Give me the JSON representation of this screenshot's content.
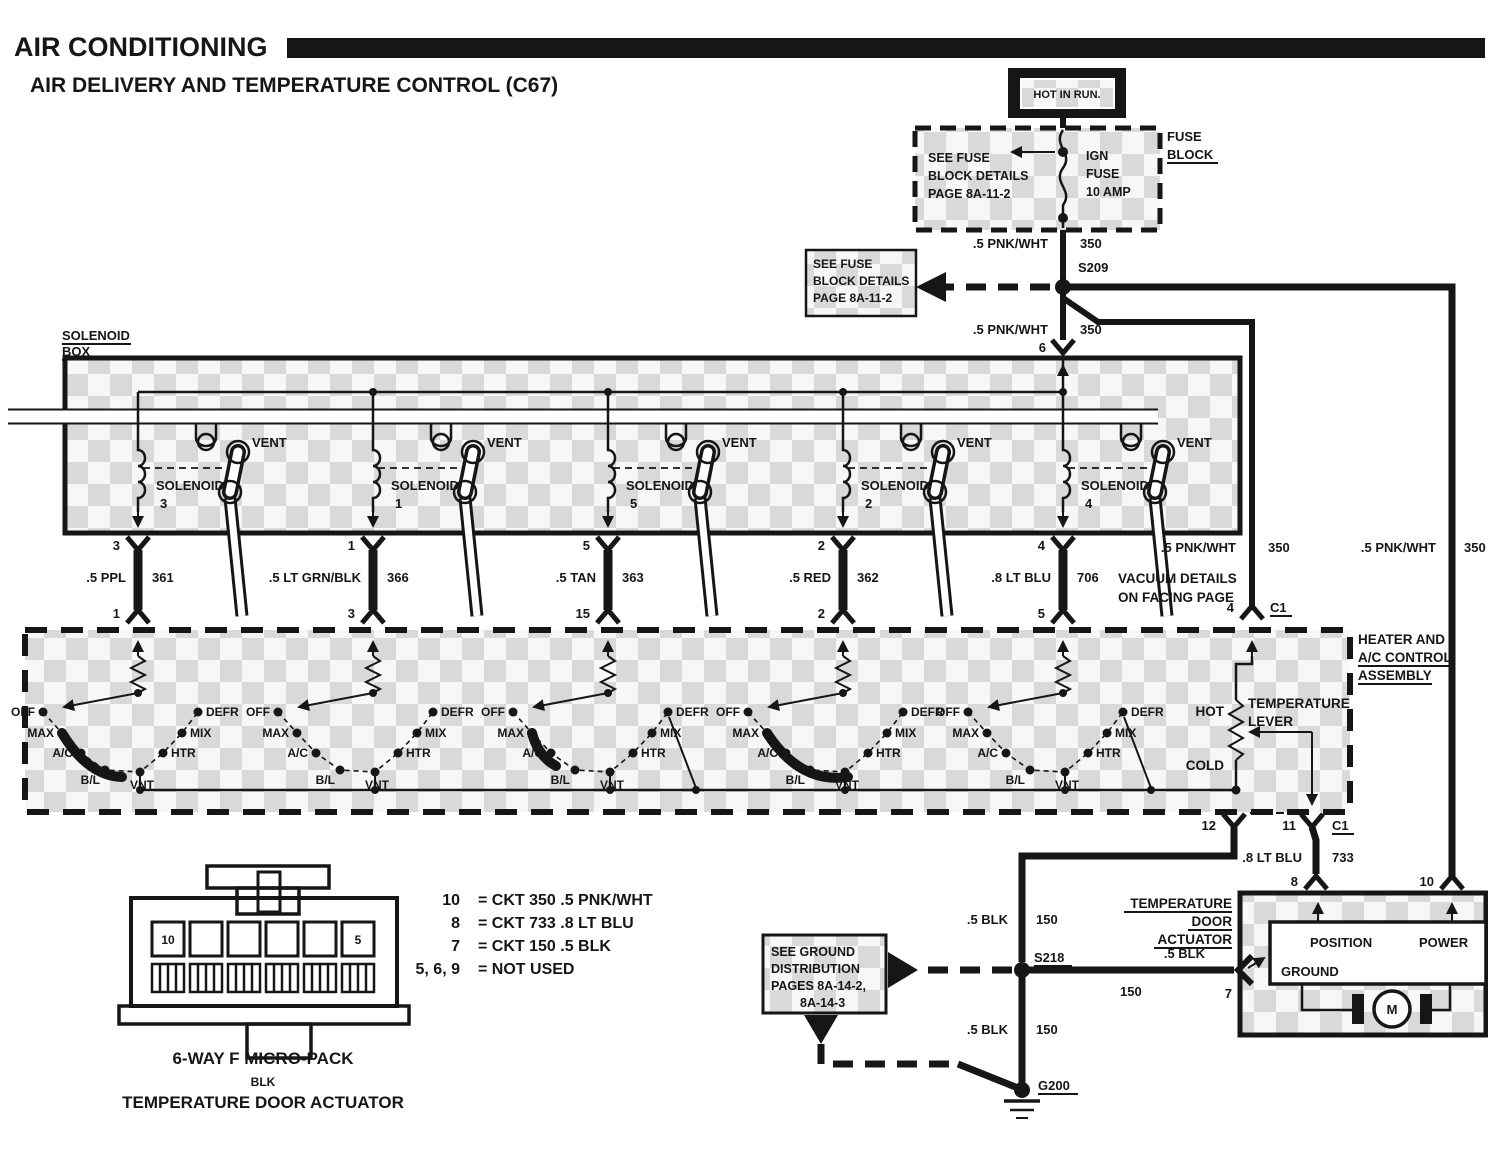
{
  "title": "AIR CONDITIONING",
  "subtitle": "AIR DELIVERY AND TEMPERATURE CONTROL (C67)",
  "power": {
    "hot_in_run": "HOT IN RUN.",
    "fuse_block": [
      "FUSE",
      "BLOCK"
    ],
    "fuse_note": [
      "SEE FUSE",
      "BLOCK DETAILS",
      "PAGE 8A-11-2"
    ],
    "ign_fuse": [
      "IGN",
      "FUSE",
      "10 AMP"
    ],
    "splice": "S209",
    "ref_note": [
      "SEE FUSE",
      "BLOCK DETAILS",
      "PAGE 8A-11-2"
    ],
    "wire_pnk": ".5 PNK/WHT",
    "ckt_350": "350",
    "pin6": "6"
  },
  "solenoid_box": {
    "label": [
      "SOLENOID",
      "BOX"
    ],
    "vent": "VENT",
    "solenoid_word": "SOLENOID",
    "units": [
      {
        "num": "3",
        "pin_top": "3",
        "wire": ".5 PPL",
        "ckt": "361",
        "pin_bottom": "1"
      },
      {
        "num": "1",
        "pin_top": "1",
        "wire": ".5 LT GRN/BLK",
        "ckt": "366",
        "pin_bottom": "3"
      },
      {
        "num": "5",
        "pin_top": "5",
        "wire": ".5 TAN",
        "ckt": "363",
        "pin_bottom": "15"
      },
      {
        "num": "2",
        "pin_top": "2",
        "wire": ".5 RED",
        "ckt": "362",
        "pin_bottom": "2"
      },
      {
        "num": "4",
        "pin_top": "4",
        "wire": ".8 LT BLU",
        "ckt": "706",
        "pin_bottom": "5"
      }
    ],
    "vacuum_note": [
      "VACUUM DETAILS",
      "ON FACING PAGE"
    ]
  },
  "assembly": {
    "label": [
      "HEATER AND",
      "A/C CONTROL",
      "ASSEMBLY"
    ],
    "positions": [
      "OFF",
      "MAX",
      "A/C",
      "B/L",
      "VNT",
      "HTR",
      "MIX",
      "DEFR"
    ],
    "temp_lever": [
      "TEMPERATURE",
      "LEVER"
    ],
    "hot": "HOT",
    "cold": "COLD",
    "pin4": "4",
    "c1": "C1",
    "pin12": "12",
    "pin11": "11",
    "wire_blu": ".8 LT BLU",
    "ckt_733": "733"
  },
  "actuator": {
    "label": [
      "TEMPERATURE",
      "DOOR",
      "ACTUATOR"
    ],
    "position": "POSITION",
    "power": "POWER",
    "ground": "GROUND",
    "motor": "M",
    "pin8": "8",
    "pin10": "10",
    "pin7": "7"
  },
  "ground": {
    "splice": "S218",
    "g200": "G200",
    "wire_blk": ".5 BLK",
    "ckt_150": "150",
    "note": [
      "SEE GROUND",
      "DISTRIBUTION",
      "PAGES 8A-14-2,",
      "8A-14-3"
    ]
  },
  "legend": {
    "rows": [
      {
        "pin": "10",
        "desc": "=  CKT 350  .5 PNK/WHT"
      },
      {
        "pin": "8",
        "desc": "=  CKT 733  .8 LT BLU"
      },
      {
        "pin": "7",
        "desc": "=  CKT 150  .5 BLK"
      },
      {
        "pin": "5, 6, 9",
        "desc": "=  NOT USED"
      }
    ]
  },
  "connector": {
    "cavity_first": "10",
    "cavity_last": "5",
    "caption": [
      "6-WAY F MICRO-PACK",
      "BLK",
      "TEMPERATURE DOOR ACTUATOR"
    ]
  },
  "colors": {
    "ink": "#161616",
    "shade": "#d9d9d9",
    "paper": "#ffffff"
  }
}
